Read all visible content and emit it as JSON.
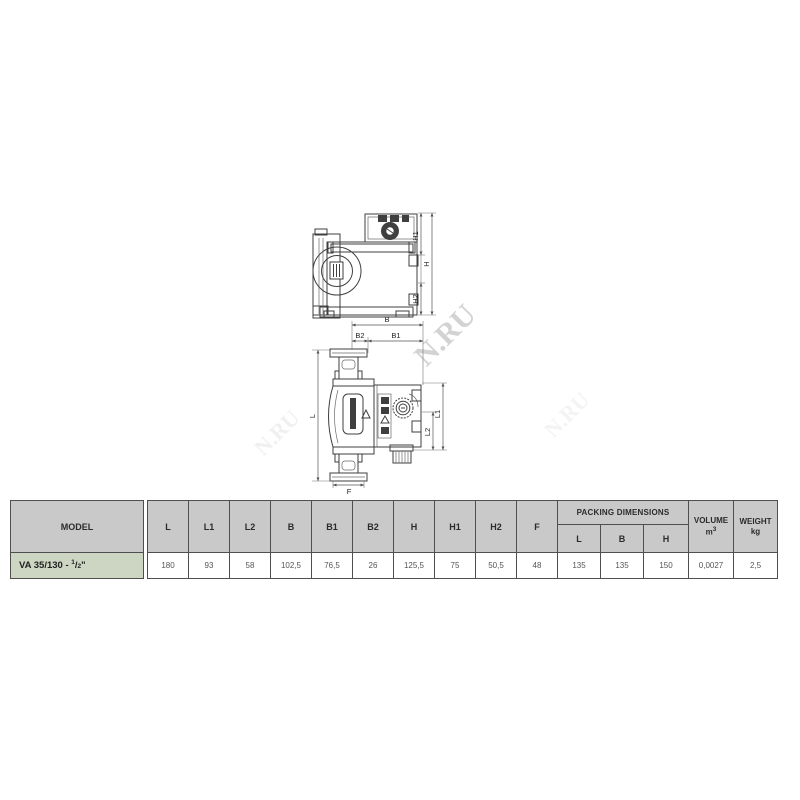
{
  "drawing": {
    "top_view": {
      "labels": {
        "h1": "H1",
        "h": "H",
        "h2": "H2"
      }
    },
    "front_view": {
      "labels": {
        "b": "B",
        "b2": "B2",
        "b1": "B1",
        "l": "L",
        "l1": "L1",
        "l2": "L2",
        "f": "F"
      }
    }
  },
  "watermark": {
    "text": "N.RU"
  },
  "colors": {
    "header_bg": "#c9c9c9",
    "model_row_bg": "#ccd6c2",
    "table_border": "#4f4f4f",
    "drawing_line": "#3f3f3f"
  },
  "table": {
    "model_header": "MODEL",
    "dim_headers": [
      "L",
      "L1",
      "L2",
      "B",
      "B1",
      "B2",
      "H",
      "H1",
      "H2",
      "F"
    ],
    "packing": {
      "title": "PACKING DIMENSIONS",
      "subs": [
        "L",
        "B",
        "H"
      ]
    },
    "volume": {
      "line1": "VOLUME",
      "unit_base": "m",
      "unit_sup": "3"
    },
    "weight": {
      "line1": "WEIGHT",
      "unit": "kg"
    },
    "row": {
      "model": {
        "prefix": "VA 35/130 - ",
        "frac_num": "1",
        "frac_slash": "/",
        "frac_den": "2",
        "suffix": "\""
      },
      "values": [
        "180",
        "93",
        "58",
        "102,5",
        "76,5",
        "26",
        "125,5",
        "75",
        "50,5",
        "48",
        "135",
        "135",
        "150",
        "0,0027",
        "2,5"
      ]
    }
  }
}
